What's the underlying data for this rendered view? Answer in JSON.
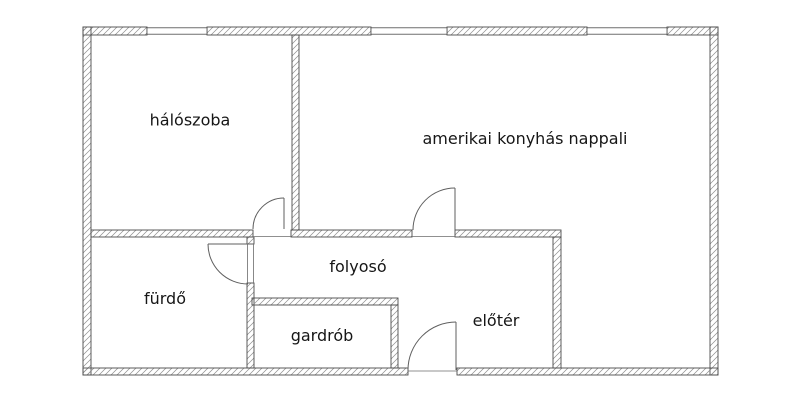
{
  "plan": {
    "colors": {
      "background": "#ffffff",
      "wall_line": "#4b4b4b",
      "hatch_line": "#8d8d8d",
      "door_line": "#5f5f5f",
      "label_text": "#161616"
    },
    "rooms": [
      {
        "id": "haloszoba",
        "label": "hálószoba"
      },
      {
        "id": "nappali",
        "label": "amerikai konyhás nappali"
      },
      {
        "id": "furdo",
        "label": "fürdő"
      },
      {
        "id": "folyoso",
        "label": "folyosó"
      },
      {
        "id": "gardrob",
        "label": "gardrób"
      },
      {
        "id": "eloter",
        "label": "előtér"
      }
    ],
    "doors": [
      {
        "id": "bedroom-door",
        "between": [
          "hálószoba",
          "folyosó"
        ]
      },
      {
        "id": "living-room-door",
        "between": [
          "amerikai konyhás nappali",
          "előtér"
        ]
      },
      {
        "id": "bathroom-door",
        "between": [
          "fürdő",
          "folyosó"
        ]
      },
      {
        "id": "entrance-door",
        "between": [
          "előtér",
          "outside"
        ]
      }
    ],
    "windows": [
      {
        "id": "window-1",
        "wall": "top"
      },
      {
        "id": "window-2",
        "wall": "top"
      },
      {
        "id": "window-3",
        "wall": "top"
      }
    ]
  }
}
